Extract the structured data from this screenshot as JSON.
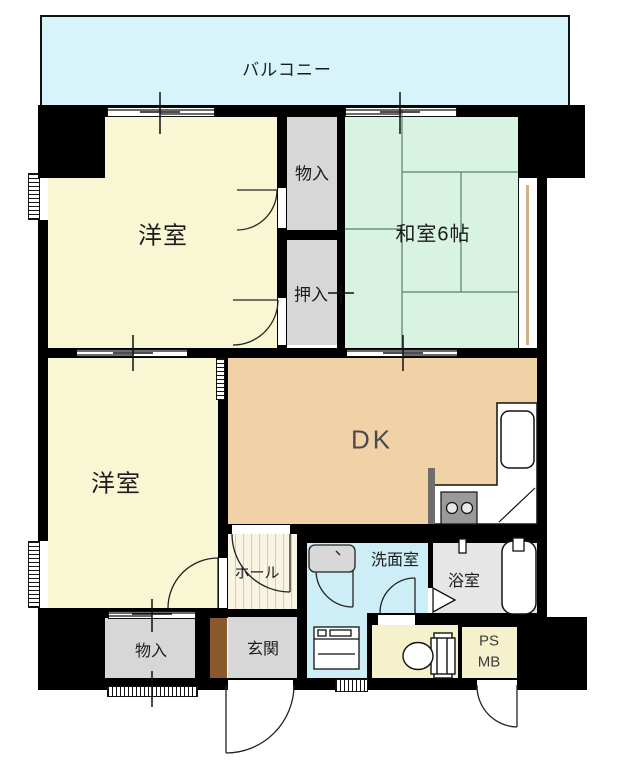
{
  "title": "2DK apartment floor plan",
  "colors": {
    "wall": "#000000",
    "balcony": "#d6f4f9",
    "western_room": "#f9f7d3",
    "japanese_room": "#d9f3e2",
    "dining_kitchen": "#f1d2a6",
    "washroom": "#cdeef6",
    "hall": "#faf4e2",
    "gray_room": "#d7d7d7",
    "bathroom": "#e6e6e6",
    "toilet_ps": "#f6f1cd",
    "cabinet_brown": "#8a5a2e",
    "tatami_line": "#57806b",
    "window_tan": "#d2b08a"
  },
  "rooms": {
    "balcony": {
      "label": "バルコニー"
    },
    "western_room_upper": {
      "label": "洋室"
    },
    "japanese_room": {
      "label": "和室6帖"
    },
    "storage_upper": {
      "label": "物入"
    },
    "closet": {
      "label": "押入"
    },
    "western_room_lower": {
      "label": "洋室"
    },
    "dining_kitchen": {
      "label": "DK"
    },
    "hall": {
      "label": "ホール"
    },
    "washroom": {
      "label": "洗面室"
    },
    "bathroom": {
      "label": "浴室"
    },
    "entrance": {
      "label": "玄関"
    },
    "storage_lower": {
      "label": "物入"
    },
    "pipe_space": {
      "label_line1": "PS",
      "label_line2": "MB"
    }
  },
  "icons": {
    "toilet": "toilet-icon",
    "bathtub": "bathtub-icon",
    "bath_tap": "bath-tap-icon",
    "shower": "shower-icon",
    "bath_door": "bath-folding-door-icon",
    "washbasin": "washbasin-icon",
    "washing_machine": "washing-machine-icon",
    "kitchen_sink": "kitchen-sink-icon",
    "stove": "stove-burners-icon",
    "door_swing": "door-swing-arc",
    "tatami": "tatami-mat-lines"
  }
}
